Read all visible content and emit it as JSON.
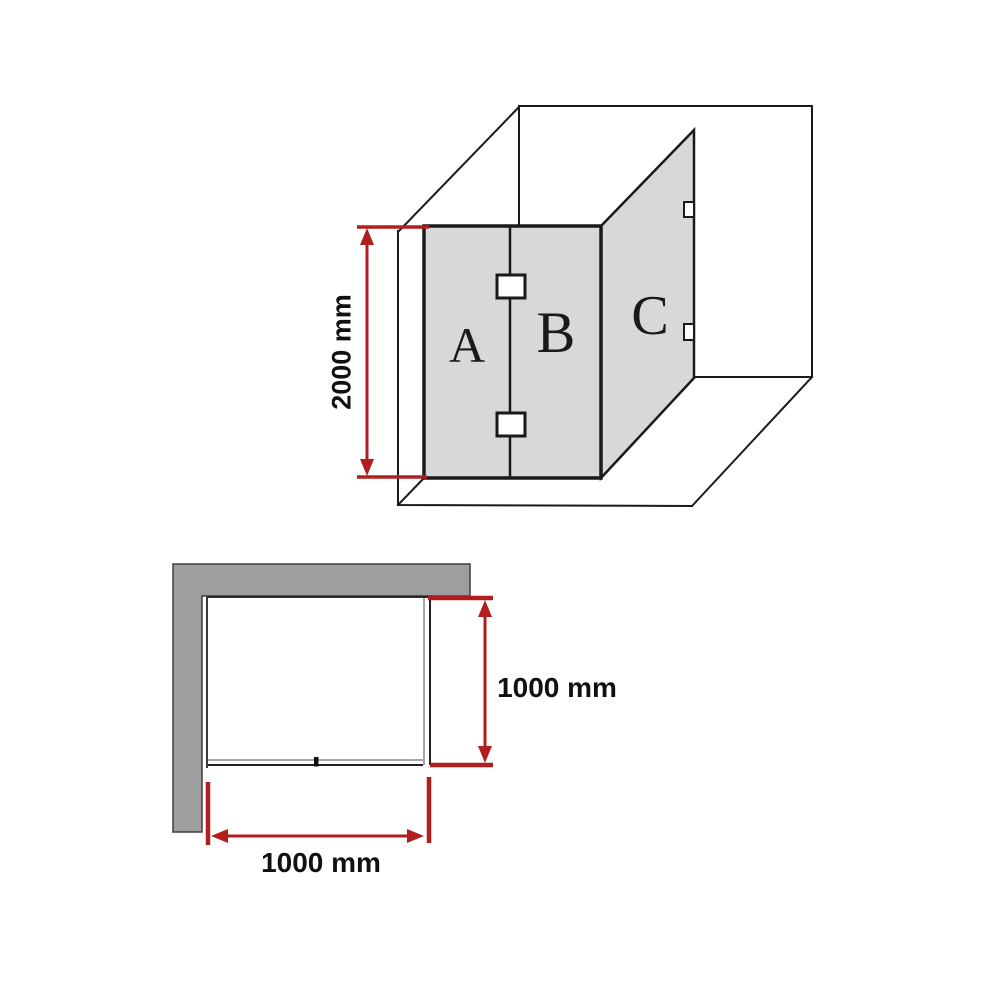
{
  "diagram": {
    "description": "corner shower screen dimension diagram",
    "views": [
      "perspective",
      "plan"
    ]
  },
  "perspective_view": {
    "panels": [
      {
        "label": "A"
      },
      {
        "label": "B"
      },
      {
        "label": "C"
      }
    ],
    "hinge_count_front": 2,
    "bracket_count_return": 2,
    "height_dimension": {
      "label": "2000 mm",
      "value_mm": 2000
    }
  },
  "plan_view": {
    "width_dimension": {
      "label": "1000 mm",
      "value_mm": 1000
    },
    "depth_dimension": {
      "label": "1000 mm",
      "value_mm": 1000
    }
  },
  "colors": {
    "line_black": "#1a1a1a",
    "panel_glass_fill": "#d8d8d8",
    "wall_gray_fill": "#9e9e9e",
    "wall_outline": "#3f3f3f",
    "dimension_red": "#b01e1e",
    "glass_edge_gray": "#8a8a8a",
    "background": "#ffffff"
  }
}
